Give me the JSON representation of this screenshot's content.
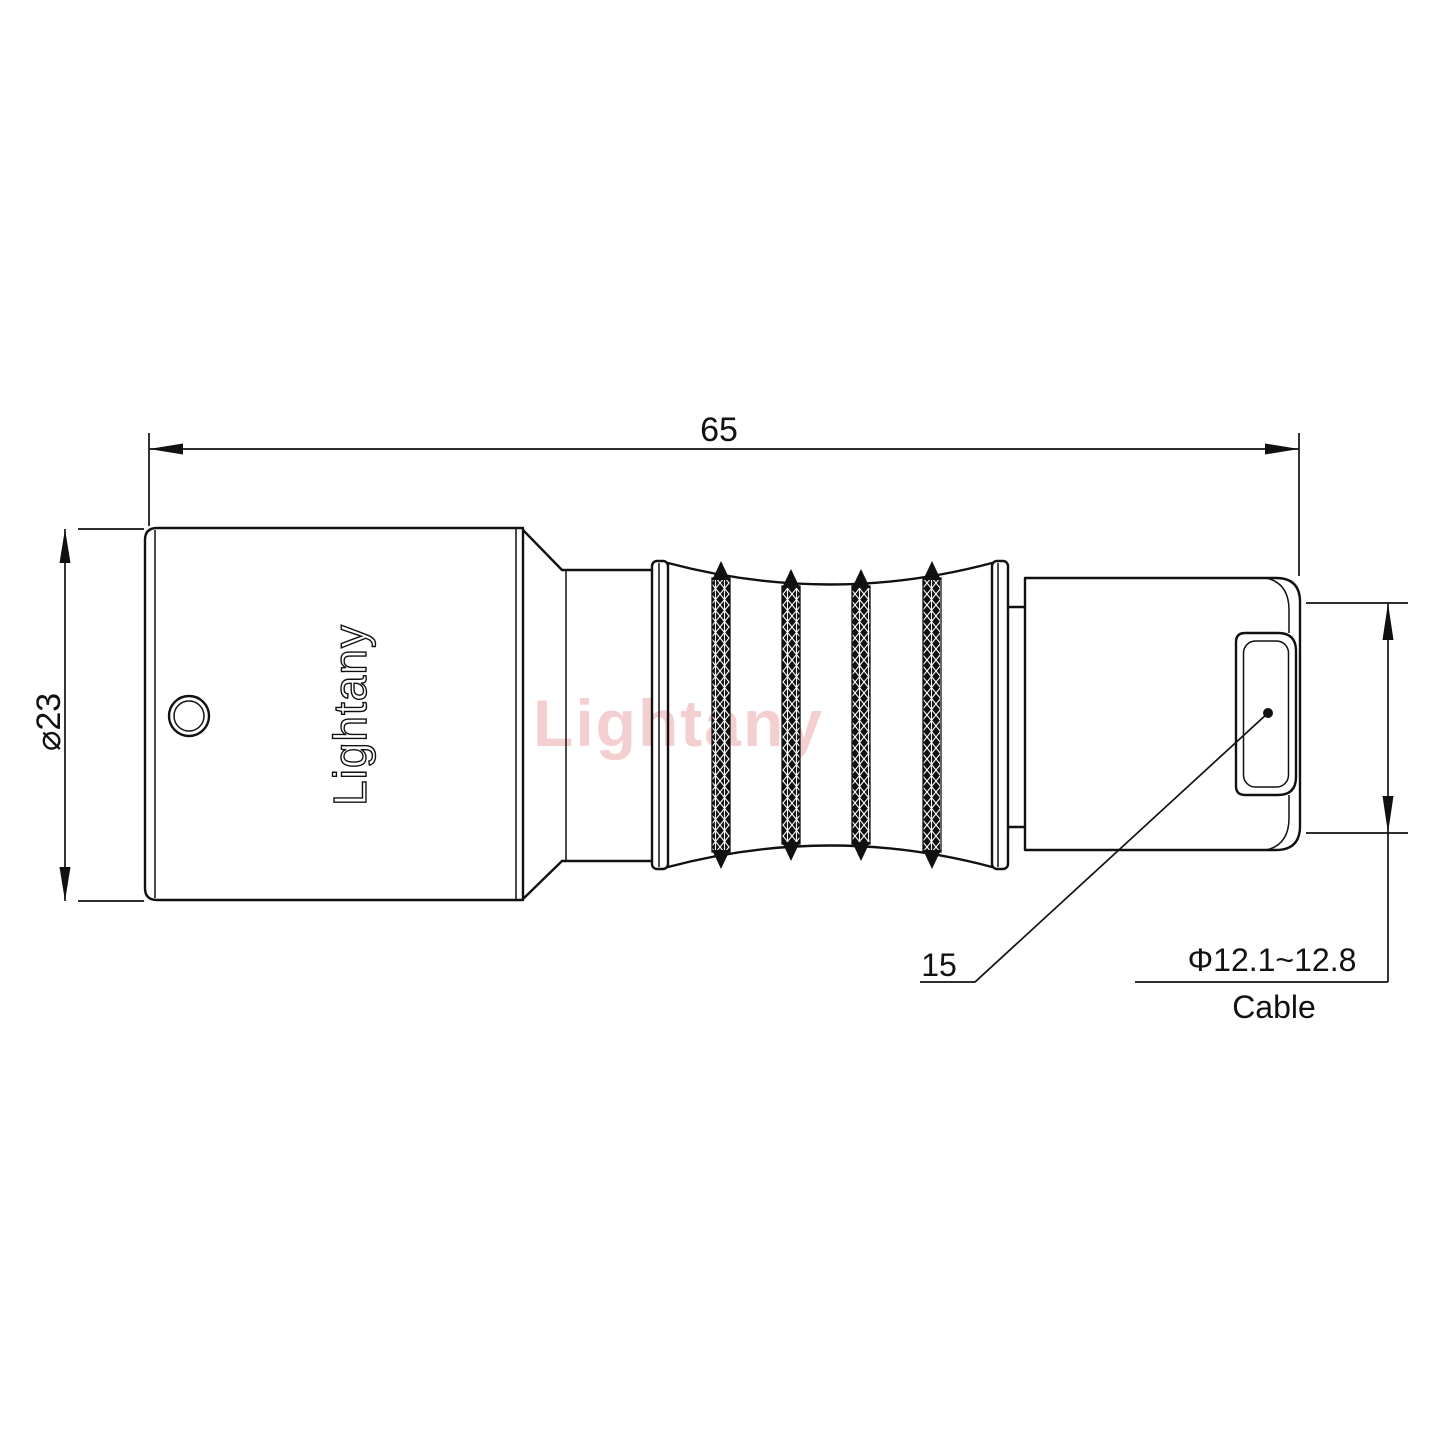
{
  "drawing": {
    "watermark_text": "Lightany",
    "engraving_text": "Lightany",
    "dims": {
      "overall_length": "65",
      "body_diameter": "⌀23",
      "rear_section": "15",
      "cable_diameter": "Φ12.1~12.8",
      "cable_label": "Cable"
    },
    "colors": {
      "line": "#111111",
      "watermark": "#e58f8f"
    }
  }
}
